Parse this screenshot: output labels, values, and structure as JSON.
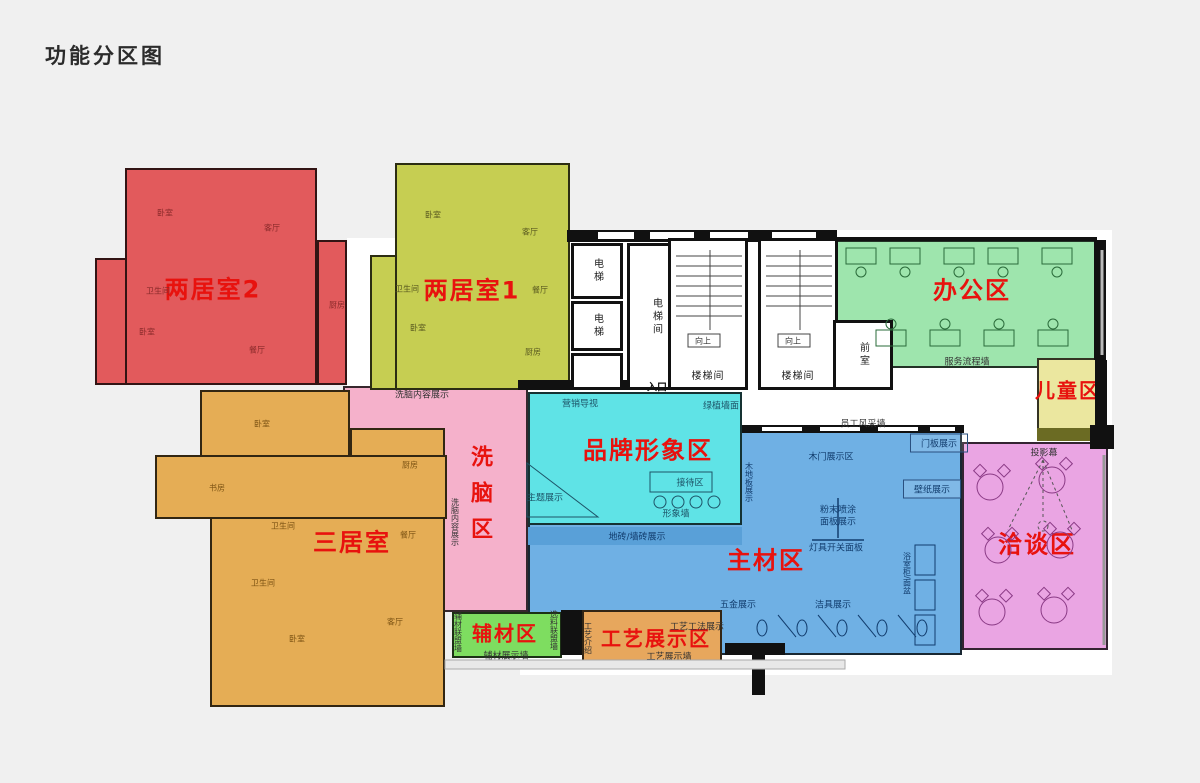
{
  "title": "功能分区图",
  "colors": {
    "zone_label": "#e8120e",
    "wall": "#111111",
    "background": "#f0f0f0",
    "floor": "#ffffff"
  },
  "floorplan": {
    "base": [
      {
        "n": "building-core-base",
        "r": [
          520,
          230,
          592,
          445
        ]
      },
      {
        "n": "corridor-left-base",
        "r": [
          347,
          238,
          50,
          150
        ]
      }
    ],
    "zones": [
      {
        "n": "zone-brainwash",
        "f": "#f5b1cb",
        "rects": [
          [
            343,
            386,
            185,
            226
          ]
        ],
        "label": {
          "t": "洗脑区",
          "x": 479,
          "y": 445,
          "s": 22,
          "v": true
        }
      },
      {
        "n": "zone-two-bedroom-2",
        "f": "#e25a5c",
        "tex": true,
        "rects": [
          [
            125,
            168,
            192,
            217
          ],
          [
            95,
            258,
            32,
            127
          ],
          [
            317,
            240,
            30,
            145
          ]
        ],
        "label": {
          "t": "两居室2",
          "x": 213,
          "y": 287,
          "s": 24
        }
      },
      {
        "n": "zone-two-bedroom-1",
        "f": "#c6ce52",
        "tex": true,
        "rects": [
          [
            395,
            163,
            175,
            227
          ],
          [
            370,
            255,
            27,
            135
          ]
        ],
        "label": {
          "t": "两居室1",
          "x": 472,
          "y": 288,
          "s": 24
        }
      },
      {
        "n": "zone-three-bedroom",
        "f": "#e5ad55",
        "tex": true,
        "rects": [
          [
            200,
            390,
            150,
            67
          ],
          [
            350,
            428,
            95,
            92
          ],
          [
            155,
            455,
            292,
            64
          ],
          [
            210,
            517,
            235,
            190
          ]
        ],
        "label": {
          "t": "三居室",
          "x": 352,
          "y": 540,
          "s": 24
        }
      },
      {
        "n": "zone-main-materials",
        "f": "#6fb0e4",
        "rects": [
          [
            528,
            425,
            434,
            230
          ]
        ],
        "label": {
          "t": "主材区",
          "x": 766,
          "y": 558,
          "s": 24
        }
      },
      {
        "n": "band-tile-display",
        "f": "#59a0d8",
        "nob": true,
        "rects": [
          [
            528,
            527,
            214,
            18
          ]
        ]
      },
      {
        "n": "zone-brand-image",
        "f": "#5fe3e6",
        "rects": [
          [
            528,
            392,
            214,
            133
          ]
        ],
        "label": {
          "t": "品牌形象区",
          "x": 648,
          "y": 448,
          "s": 24
        }
      },
      {
        "n": "zone-office",
        "f": "#9ee5ad",
        "rects": [
          [
            833,
            240,
            263,
            128
          ]
        ],
        "label": {
          "t": "办公区",
          "x": 972,
          "y": 288,
          "s": 24
        }
      },
      {
        "n": "zone-kids",
        "f": "#ebe79f",
        "rects": [
          [
            1037,
            358,
            64,
            80
          ]
        ],
        "label": {
          "t": "儿童区",
          "x": 1068,
          "y": 389,
          "s": 20
        }
      },
      {
        "n": "kids-zone-dark-strip",
        "f": "#6b6b23",
        "nob": true,
        "rects": [
          [
            1037,
            428,
            68,
            13
          ]
        ]
      },
      {
        "n": "zone-negotiation",
        "f": "#eaa5e3",
        "rects": [
          [
            962,
            442,
            146,
            208
          ]
        ],
        "label": {
          "t": "洽谈区",
          "x": 1037,
          "y": 542,
          "s": 24
        }
      },
      {
        "n": "zone-aux-materials",
        "f": "#7edd60",
        "rects": [
          [
            452,
            612,
            110,
            46
          ]
        ],
        "label": {
          "t": "辅材区",
          "x": 505,
          "y": 632,
          "s": 20
        }
      },
      {
        "n": "zone-craft-display",
        "f": "#e7a75d",
        "rects": [
          [
            582,
            610,
            140,
            53
          ]
        ],
        "label": {
          "t": "工艺展示区",
          "x": 656,
          "y": 637,
          "s": 20
        }
      }
    ],
    "walls": [
      {
        "n": "wall-top-center",
        "r": [
          567,
          230,
          270,
          12
        ]
      },
      {
        "n": "wall-office-top",
        "r": [
          835,
          237,
          262,
          4
        ]
      },
      {
        "n": "wall-right-upper",
        "r": [
          1094,
          240,
          12,
          120
        ]
      },
      {
        "n": "wall-kids-right",
        "r": [
          1095,
          360,
          12,
          67
        ]
      },
      {
        "n": "wall-kids-corner",
        "r": [
          1090,
          425,
          24,
          24
        ]
      },
      {
        "n": "wall-entry-left",
        "r": [
          518,
          380,
          128,
          10
        ]
      },
      {
        "n": "wall-entry-right",
        "r": [
          670,
          380,
          72,
          10
        ]
      },
      {
        "n": "wall-materials-top",
        "r": [
          742,
          425,
          222,
          8
        ]
      },
      {
        "n": "wall-aux-craft-block",
        "r": [
          561,
          610,
          21,
          45
        ]
      },
      {
        "n": "wall-bottom-center-a",
        "r": [
          725,
          643,
          60,
          12
        ]
      },
      {
        "n": "wall-bottom-center-b",
        "r": [
          752,
          655,
          13,
          40
        ]
      }
    ],
    "gaps": [
      {
        "n": "window-top-1",
        "r": [
          598,
          232,
          36,
          7
        ]
      },
      {
        "n": "window-top-2",
        "r": [
          650,
          232,
          44,
          7
        ]
      },
      {
        "n": "window-top-3",
        "r": [
          710,
          232,
          38,
          7
        ]
      },
      {
        "n": "window-top-4",
        "r": [
          772,
          232,
          44,
          7
        ]
      },
      {
        "n": "window-mat-1",
        "r": [
          762,
          427,
          40,
          4
        ]
      },
      {
        "n": "window-mat-2",
        "r": [
          820,
          427,
          40,
          4
        ]
      },
      {
        "n": "window-mat-3",
        "r": [
          878,
          427,
          40,
          4
        ]
      },
      {
        "n": "window-mat-4",
        "r": [
          930,
          427,
          25,
          4
        ]
      }
    ],
    "rooms": [
      {
        "n": "room-elevator-1",
        "r": [
          571,
          243,
          52,
          56
        ],
        "t": "电梯",
        "v": true
      },
      {
        "n": "room-elevator-2",
        "r": [
          571,
          301,
          52,
          50
        ],
        "t": "电梯",
        "v": true
      },
      {
        "n": "room-utility",
        "r": [
          571,
          353,
          52,
          37
        ],
        "t": ""
      },
      {
        "n": "room-elevator-hall",
        "r": [
          627,
          243,
          58,
          147
        ],
        "t": "电梯间",
        "v": true
      },
      {
        "n": "room-stairwell-1",
        "r": [
          668,
          238,
          80,
          152
        ],
        "t": "楼梯间",
        "la": "bottom"
      },
      {
        "n": "room-stairwell-2",
        "r": [
          758,
          238,
          80,
          152
        ],
        "t": "楼梯间",
        "la": "bottom"
      },
      {
        "n": "room-front",
        "r": [
          833,
          320,
          60,
          70
        ],
        "t": "前室",
        "v": true
      }
    ],
    "notes": [
      {
        "n": "entrance-label",
        "t": "入口",
        "x": 657,
        "y": 386,
        "c": "#111",
        "s": 10,
        "w": "bold"
      },
      {
        "n": "up-arrow-label-1",
        "t": "向上",
        "x": 703,
        "y": 341,
        "c": "#333",
        "s": 8
      },
      {
        "n": "up-arrow-label-2",
        "t": "向上",
        "x": 793,
        "y": 341,
        "c": "#333",
        "s": 8
      },
      {
        "n": "marketing-signage-label",
        "t": "营销导视",
        "x": 580,
        "y": 403,
        "c": "#1d5468",
        "s": 9
      },
      {
        "n": "green-plant-wall-label",
        "t": "绿植墙面",
        "x": 721,
        "y": 405,
        "c": "#1d5468",
        "s": 9
      },
      {
        "n": "theme-display-label",
        "t": "主题展示",
        "x": 545,
        "y": 497,
        "c": "#1d5468",
        "s": 9
      },
      {
        "n": "reception-area-label",
        "t": "接待区",
        "x": 690,
        "y": 482,
        "c": "#1d5468",
        "s": 9
      },
      {
        "n": "image-wall-label",
        "t": "形象墙",
        "x": 676,
        "y": 513,
        "c": "#1d5468",
        "s": 9
      },
      {
        "n": "tile-display-label",
        "t": "地砖/墙砖展示",
        "x": 637,
        "y": 536,
        "c": "#123d6e",
        "s": 9
      },
      {
        "n": "wood-door-display-label",
        "t": "木门展示区",
        "x": 831,
        "y": 456,
        "c": "#123d6e",
        "s": 9
      },
      {
        "n": "door-panel-display-label",
        "t": "门板展示",
        "x": 939,
        "y": 443,
        "c": "#123d6e",
        "s": 9,
        "bx": true
      },
      {
        "n": "wallpaper-display-label",
        "t": "壁纸展示",
        "x": 932,
        "y": 489,
        "c": "#123d6e",
        "s": 9,
        "bx": true
      },
      {
        "n": "powder-spray-label-1",
        "t": "粉末喷涂",
        "x": 838,
        "y": 509,
        "c": "#123d6e",
        "s": 9
      },
      {
        "n": "powder-spray-label-2",
        "t": "面板展示",
        "x": 838,
        "y": 521,
        "c": "#123d6e",
        "s": 9
      },
      {
        "n": "lamp-switch-panel-label",
        "t": "灯具开关面板",
        "x": 836,
        "y": 547,
        "c": "#123d6e",
        "s": 9
      },
      {
        "n": "wood-floor-display-label",
        "t": "木地板展示",
        "x": 749,
        "y": 462,
        "c": "#123d6e",
        "s": 8,
        "v": true
      },
      {
        "n": "bath-cabinet-basin-label",
        "t": "浴室柜/面盆",
        "x": 907,
        "y": 552,
        "c": "#123d6e",
        "s": 8,
        "v": true
      },
      {
        "n": "sanitary-ware-display-label",
        "t": "洁具展示",
        "x": 833,
        "y": 604,
        "c": "#123d6e",
        "s": 9
      },
      {
        "n": "hardware-display-label",
        "t": "五金展示",
        "x": 738,
        "y": 604,
        "c": "#123d6e",
        "s": 9
      },
      {
        "n": "staff-style-wall-label",
        "t": "员工风采墙",
        "x": 863,
        "y": 423,
        "c": "#333",
        "s": 9
      },
      {
        "n": "service-process-wall-label",
        "t": "服务流程墙",
        "x": 967,
        "y": 361,
        "c": "#333",
        "s": 9
      },
      {
        "n": "projection-screen-label",
        "t": "投影幕",
        "x": 1044,
        "y": 452,
        "c": "#333",
        "s": 9
      },
      {
        "n": "brainwash-content-label-h",
        "t": "洗脑内容展示",
        "x": 422,
        "y": 394,
        "c": "#333",
        "s": 9
      },
      {
        "n": "brainwash-content-label-v",
        "t": "洗脑内容展示",
        "x": 455,
        "y": 498,
        "c": "#333",
        "s": 8,
        "v": true
      },
      {
        "n": "aux-alliance-wall-label",
        "t": "辅材联盟墙",
        "x": 458,
        "y": 612,
        "c": "#333",
        "s": 8,
        "v": true
      },
      {
        "n": "material-select-wall-label",
        "t": "选料联盟墙",
        "x": 554,
        "y": 610,
        "c": "#333",
        "s": 8,
        "v": true
      },
      {
        "n": "aux-display-wall-label",
        "t": "辅材展示墙",
        "x": 506,
        "y": 655,
        "c": "#333",
        "s": 9
      },
      {
        "n": "craft-intro-label",
        "t": "工艺介绍",
        "x": 588,
        "y": 622,
        "c": "#333",
        "s": 8,
        "v": true
      },
      {
        "n": "craft-method-display-label",
        "t": "工艺工法展示",
        "x": 697,
        "y": 626,
        "c": "#333",
        "s": 9
      },
      {
        "n": "craft-display-wall-label",
        "t": "工艺展示墙",
        "x": 669,
        "y": 656,
        "c": "#333",
        "s": 9
      },
      {
        "n": "room-label-bedroom-r1",
        "t": "卧室",
        "x": 165,
        "y": 213,
        "c": "#8a2a2a",
        "s": 8
      },
      {
        "n": "room-label-living-r",
        "t": "客厅",
        "x": 272,
        "y": 228,
        "c": "#8a2a2a",
        "s": 8
      },
      {
        "n": "room-label-bath-r",
        "t": "卫生间",
        "x": 158,
        "y": 291,
        "c": "#8a2a2a",
        "s": 8
      },
      {
        "n": "room-label-kitchen-r",
        "t": "厨房",
        "x": 337,
        "y": 305,
        "c": "#8a2a2a",
        "s": 8
      },
      {
        "n": "room-label-bedroom-r2",
        "t": "卧室",
        "x": 147,
        "y": 332,
        "c": "#8a2a2a",
        "s": 8
      },
      {
        "n": "room-label-dining-r",
        "t": "餐厅",
        "x": 257,
        "y": 350,
        "c": "#8a2a2a",
        "s": 8
      },
      {
        "n": "room-label-bedroom-g1",
        "t": "卧室",
        "x": 433,
        "y": 215,
        "c": "#5a5a20",
        "s": 8
      },
      {
        "n": "room-label-living-g",
        "t": "客厅",
        "x": 530,
        "y": 232,
        "c": "#5a5a20",
        "s": 8
      },
      {
        "n": "room-label-bath-g",
        "t": "卫生间",
        "x": 407,
        "y": 289,
        "c": "#5a5a20",
        "s": 8
      },
      {
        "n": "room-label-dining-g",
        "t": "餐厅",
        "x": 540,
        "y": 290,
        "c": "#5a5a20",
        "s": 8
      },
      {
        "n": "room-label-bedroom-g2",
        "t": "卧室",
        "x": 418,
        "y": 328,
        "c": "#5a5a20",
        "s": 8
      },
      {
        "n": "room-label-kitchen-g",
        "t": "厨房",
        "x": 533,
        "y": 352,
        "c": "#5a5a20",
        "s": 8
      },
      {
        "n": "room-label-bedroom-o1",
        "t": "卧室",
        "x": 262,
        "y": 424,
        "c": "#7d5414",
        "s": 8
      },
      {
        "n": "room-label-study-o",
        "t": "书房",
        "x": 217,
        "y": 488,
        "c": "#7d5414",
        "s": 8
      },
      {
        "n": "room-label-bath-o1",
        "t": "卫生间",
        "x": 283,
        "y": 526,
        "c": "#7d5414",
        "s": 8
      },
      {
        "n": "room-label-kitchen-o",
        "t": "厨房",
        "x": 410,
        "y": 465,
        "c": "#7d5414",
        "s": 8
      },
      {
        "n": "room-label-dining-o",
        "t": "餐厅",
        "x": 408,
        "y": 535,
        "c": "#7d5414",
        "s": 8
      },
      {
        "n": "room-label-bath-o2",
        "t": "卫生间",
        "x": 263,
        "y": 583,
        "c": "#7d5414",
        "s": 8
      },
      {
        "n": "room-label-living-o",
        "t": "客厅",
        "x": 395,
        "y": 622,
        "c": "#7d5414",
        "s": 8
      },
      {
        "n": "room-label-bedroom-o2",
        "t": "卧室",
        "x": 297,
        "y": 639,
        "c": "#7d5414",
        "s": 8
      }
    ]
  }
}
